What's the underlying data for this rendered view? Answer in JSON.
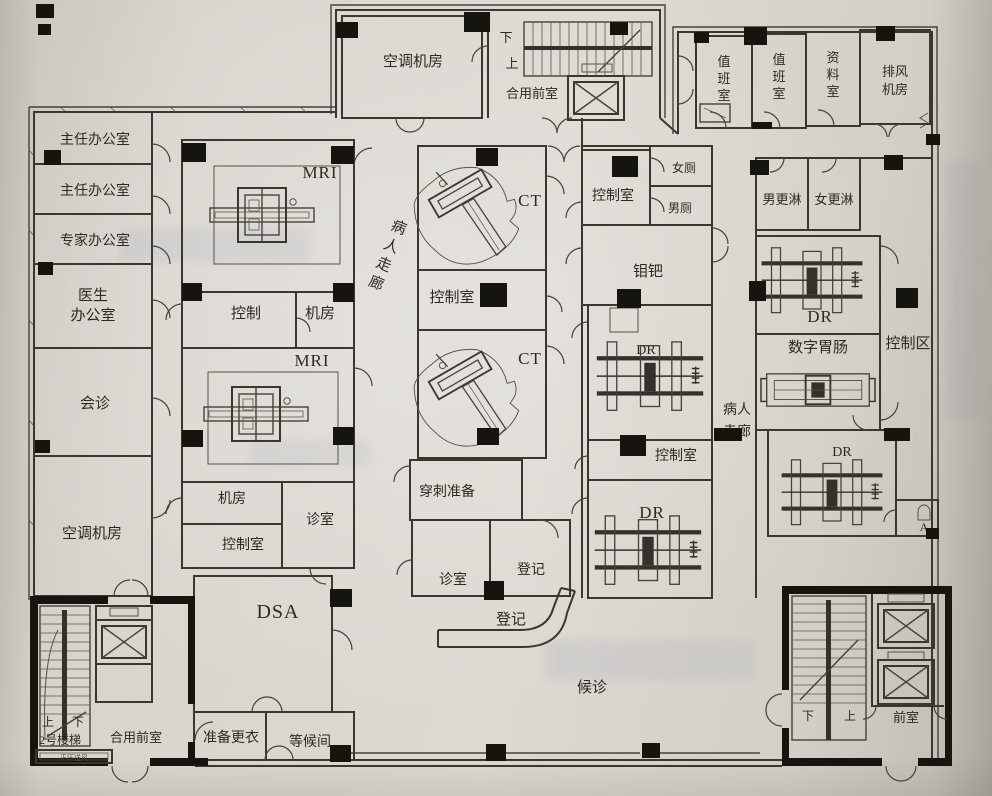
{
  "colors": {
    "paper": "#d8d4ce",
    "wall_line": "#3a3731",
    "column_black": "#16140f",
    "text_ink": "#2c2a23"
  },
  "plan": {
    "top_tower": {
      "ac_room": "空调机房",
      "down": "下",
      "up": "上",
      "shared_front_room": "合用前室"
    },
    "top_right_wing": {
      "duty_room_1": "值班室",
      "duty_room_2": "值班室",
      "archive_room": "资料室",
      "exhaust_fan_l1": "排风",
      "exhaust_fan_l2": "机房"
    },
    "left_wing": {
      "director_office_1": "主任办公室",
      "director_office_2": "主任办公室",
      "expert_office": "专家办公室",
      "doctor_office_l1": "医生",
      "doctor_office_l2": "办公室",
      "consultation": "会诊",
      "ac_room": "空调机房"
    },
    "bottom_left_tower": {
      "up": "上",
      "down": "下",
      "stair_name": "2号楼梯",
      "shared_front_room": "合用前室",
      "air_shaft": "正压送风"
    },
    "mri_block": {
      "mri_room_1": "MRI",
      "control": "控制",
      "machine_room_1": "机房",
      "mri_room_2": "MRI",
      "machine_room_2": "机房",
      "control_room": "控制室",
      "clinic": "诊室",
      "dsa_room": "DSA",
      "prep_changing": "准备更衣",
      "waiting_lounge": "等候间"
    },
    "ct_block": {
      "ct_room_1": "CT",
      "control_room": "控制室",
      "ct_room_2": "CT",
      "puncture_prep": "穿刺准备",
      "clinic": "诊室",
      "registration_room": "登记",
      "registration_desk": "登记",
      "waiting_area": "候诊"
    },
    "mid_block": {
      "control_room_top": "控制室",
      "women_toilet": "女厕",
      "men_toilet": "男厕",
      "mammography": "钼钯",
      "dr_room_1": "DR",
      "control_room_mid": "控制室",
      "dr_room_2": "DR"
    },
    "right_block": {
      "men_shower": "男更淋",
      "women_shower": "女更淋",
      "dr_room_1": "DR",
      "digital_gi": "数字胃肠",
      "dr_room_2": "DR",
      "control_area": "控制区",
      "fixture": "A"
    },
    "corridors": {
      "patient_corridor_left": "病人走廊",
      "patient_corridor_right_l1": "病人",
      "patient_corridor_right_l2": "走廊"
    },
    "bottom_right_tower": {
      "down": "下",
      "up": "上",
      "front_room": "前室"
    }
  }
}
